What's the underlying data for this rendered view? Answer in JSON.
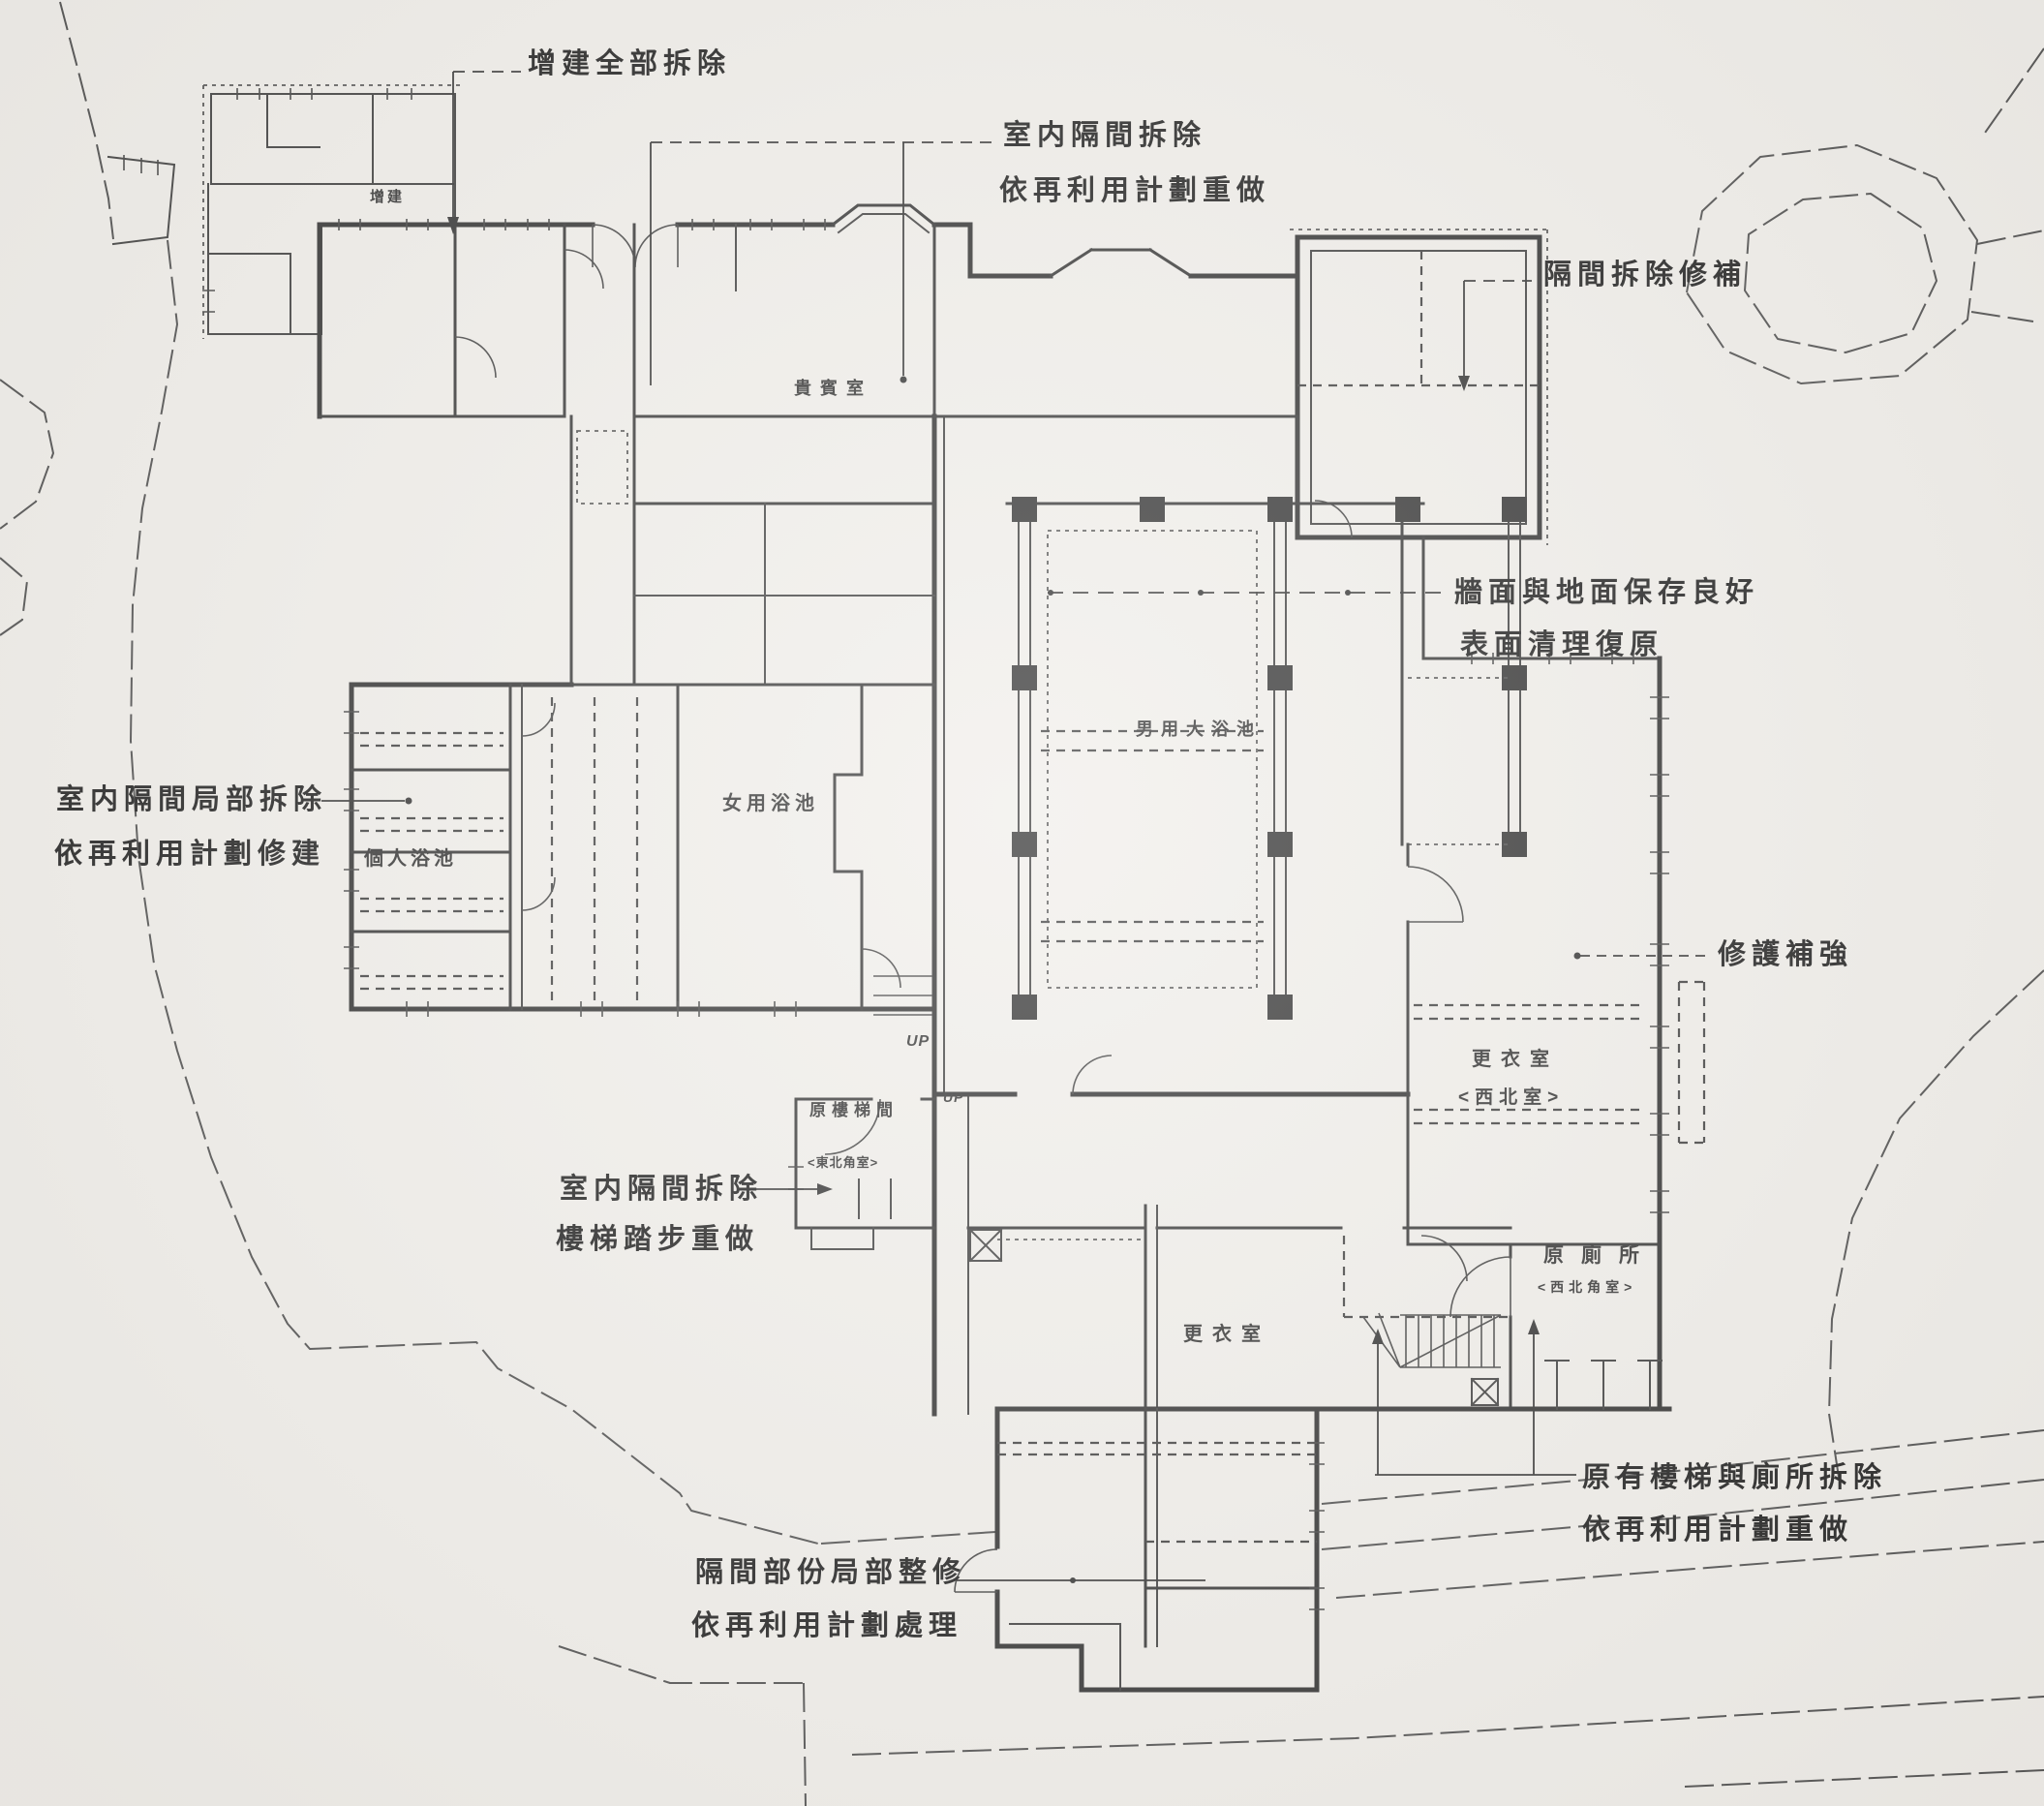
{
  "document": {
    "kind": "scanned architectural restoration floor plan",
    "language": "zh-TW"
  },
  "colors": {
    "paper": "#f1efeb",
    "ink": "#3a3a3a",
    "contour": "#545454",
    "text": "#2b2b2b"
  },
  "annotations": {
    "a1": {
      "line1": "增建全部拆除"
    },
    "a2": {
      "line1": "室内隔間拆除",
      "line2": "依再利用計劃重做"
    },
    "a3": {
      "line1": "隔間拆除修補"
    },
    "a4": {
      "line1": "牆面與地面保存良好",
      "line2": "表面清理復原"
    },
    "a5": {
      "line1": "室内隔間局部拆除",
      "line2": "依再利用計劃修建"
    },
    "a6": {
      "line1": "修護補強"
    },
    "a7": {
      "line1": "室内隔間拆除",
      "line2": "樓梯踏步重做"
    },
    "a8": {
      "line1": "原有樓梯與廁所拆除",
      "line2": "依再利用計劃重做"
    },
    "a9": {
      "line1": "隔間部份局部整修",
      "line2": "依再利用計劃處理"
    }
  },
  "rooms": {
    "addition": "增建",
    "vip_room": "貴賓室",
    "mens_bath": "男用大浴池",
    "womens_bath": "女用浴池",
    "private_bath": "個人浴池",
    "dressing_room_east": "更衣室",
    "dressing_room_east_sub": "<西北室>",
    "stair_hall": "原樓梯間",
    "stair_hall_sub": "<東北角室>",
    "dressing_room_south": "更衣室",
    "toilet": "原廁所",
    "toilet_sub": "<西北角室>",
    "up_1": "UP",
    "up_2": "UP"
  }
}
